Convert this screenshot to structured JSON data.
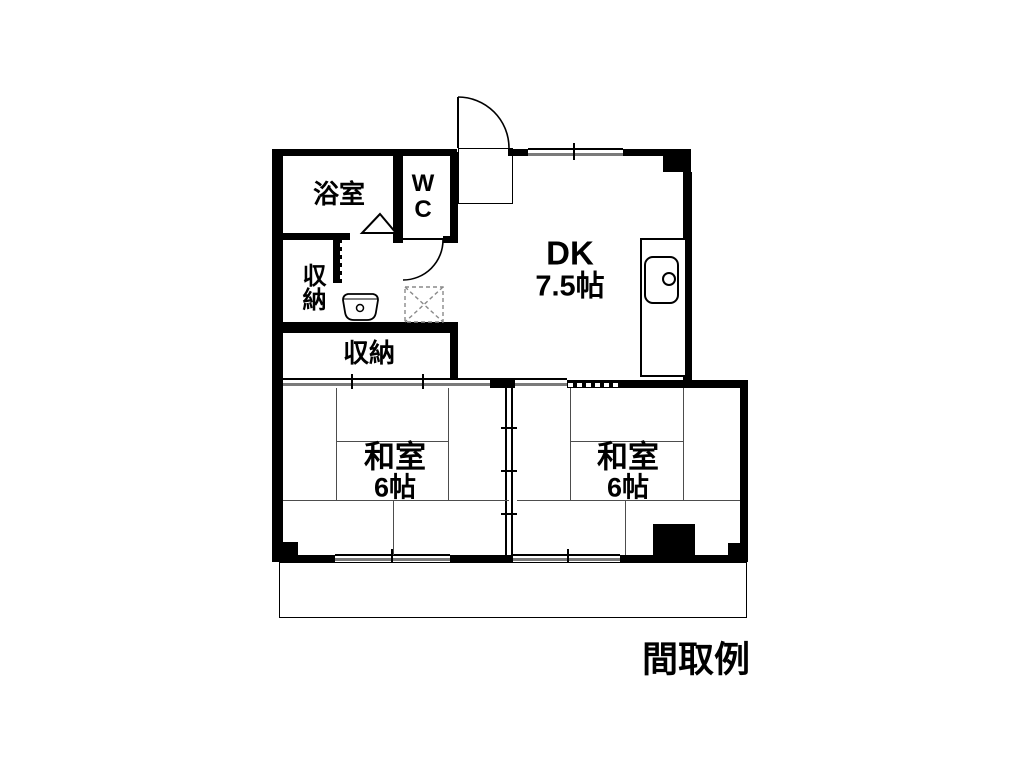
{
  "caption": "間取例",
  "rooms": {
    "bathroom": {
      "label": "浴室"
    },
    "wc": {
      "label": "WC"
    },
    "dk": {
      "label": "DK",
      "size": "7.5帖"
    },
    "storage_upper": {
      "label": "収納"
    },
    "storage_lower": {
      "label": "収納"
    },
    "washitsu_left": {
      "label": "和室",
      "size": "6帖"
    },
    "washitsu_right": {
      "label": "和室",
      "size": "6帖"
    }
  },
  "colors": {
    "wall": "#000000",
    "background": "#ffffff",
    "window_inner_line": "#7a7a7a",
    "tatami_line": "#4d4d4d"
  }
}
